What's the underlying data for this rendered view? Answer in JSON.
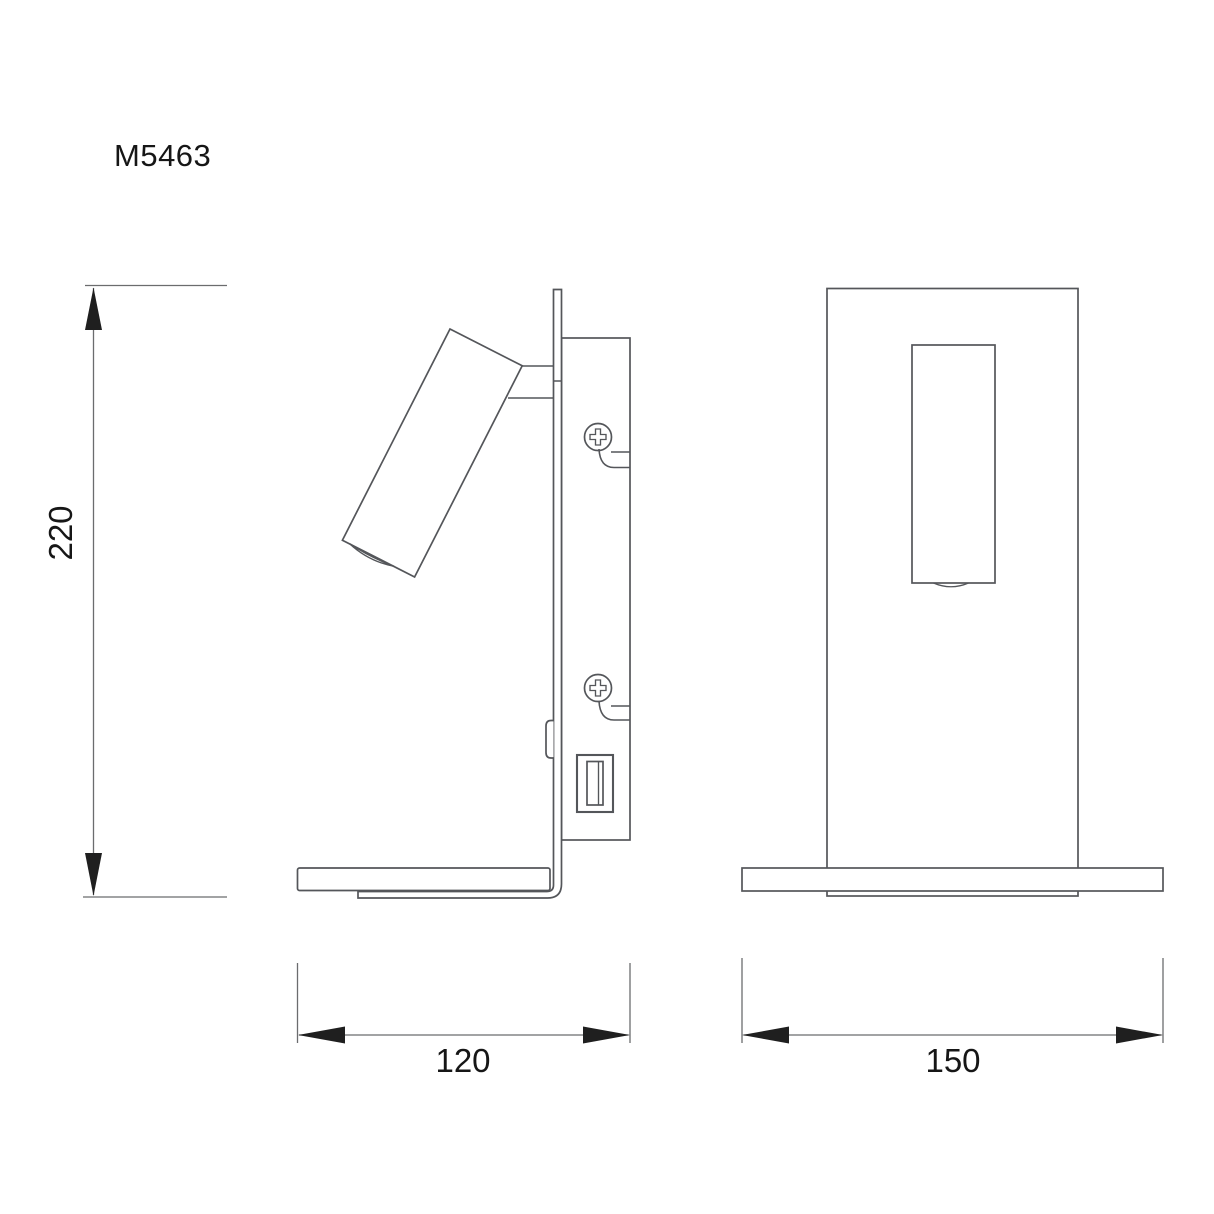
{
  "colors": {
    "background": "#ffffff",
    "line": "#54565a",
    "dim": "#6b6c6e",
    "arrow": "#1f1f1f",
    "text": "#161616"
  },
  "drawing": {
    "model": "M5463",
    "views": {
      "side": {
        "dimensions": {
          "height_label": "220",
          "width_label": "120"
        }
      },
      "front": {
        "dimensions": {
          "width_label": "150"
        }
      }
    }
  }
}
